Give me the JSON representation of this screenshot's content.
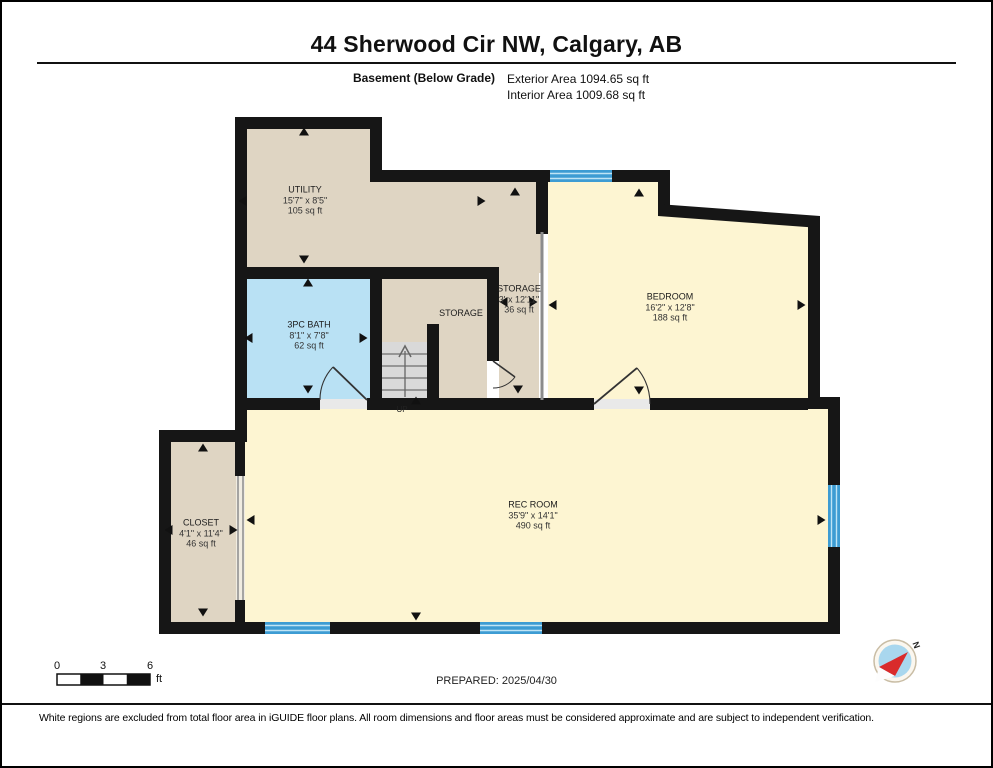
{
  "header": {
    "title": "44 Sherwood Cir NW, Calgary, AB",
    "floor_label": "Basement (Below Grade)",
    "exterior_area": "Exterior Area 1094.65 sq ft",
    "interior_area": "Interior Area 1009.68 sq ft"
  },
  "rooms": {
    "utility": {
      "name": "UTILITY",
      "dimensions": "15'7\" x 8'5\"",
      "area": "105 sq ft"
    },
    "bath": {
      "name": "3PC BATH",
      "dimensions": "8'1\" x 7'8\"",
      "area": "62 sq ft"
    },
    "storage_inner": {
      "name": "STORAGE"
    },
    "storage": {
      "name": "STORAGE",
      "dimensions": "3' x 12'11\"",
      "area": "36 sq ft"
    },
    "bedroom": {
      "name": "BEDROOM",
      "dimensions": "16'2\" x 12'8\"",
      "area": "188 sq ft"
    },
    "rec_room": {
      "name": "REC ROOM",
      "dimensions": "35'9\" x 14'1\"",
      "area": "490 sq ft"
    },
    "closet": {
      "name": "CLOSET",
      "dimensions": "4'1\" x 11'4\"",
      "area": "46 sq ft"
    }
  },
  "stairs": {
    "label": "UP"
  },
  "scale_bar": {
    "start": "0",
    "mid": "3",
    "end": "6",
    "unit": "ft"
  },
  "compass": {
    "north_label": "N"
  },
  "footer": {
    "prepared": "PREPARED: 2025/04/30",
    "disclaimer": "White regions are excluded from total floor area in iGUIDE floor plans. All room dimensions and floor areas must be considered approximate and are subject to independent verification."
  },
  "colors": {
    "wall": "#161616",
    "room_tan": "#dfd5c3",
    "room_cream": "#fdf5d2",
    "room_blue": "#b9e1f4",
    "window_blue": "#3d9cd3",
    "stairs_gray": "#d9d9d9"
  }
}
